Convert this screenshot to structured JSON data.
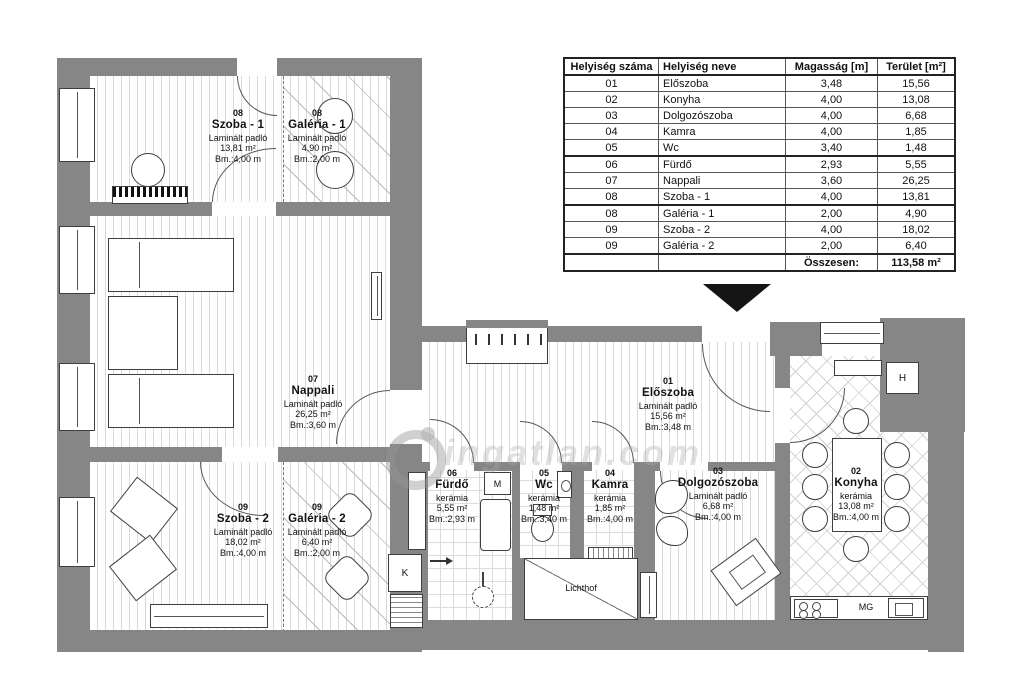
{
  "table": {
    "headers": [
      "Helyiség száma",
      "Helyiség neve",
      "Magasság [m]",
      "Terület [m²]"
    ],
    "rows": [
      [
        "01",
        "Előszoba",
        "3,48",
        "15,56"
      ],
      [
        "02",
        "Konyha",
        "4,00",
        "13,08"
      ],
      [
        "03",
        "Dolgozószoba",
        "4,00",
        "6,68"
      ],
      [
        "04",
        "Kamra",
        "4,00",
        "1,85"
      ],
      [
        "05",
        "Wc",
        "3,40",
        "1,48"
      ],
      [
        "06",
        "Fürdő",
        "2,93",
        "5,55"
      ],
      [
        "07",
        "Nappali",
        "3,60",
        "26,25"
      ],
      [
        "08",
        "Szoba - 1",
        "4,00",
        "13,81"
      ],
      [
        "08",
        "Galéria - 1",
        "2,00",
        "4,90"
      ],
      [
        "09",
        "Szoba - 2",
        "4,00",
        "18,02"
      ],
      [
        "09",
        "Galéria - 2",
        "2,00",
        "6,40"
      ]
    ],
    "total_label": "Összesen:",
    "total_value": "113,58 m²"
  },
  "plan": {
    "rooms": [
      {
        "number": "08",
        "name": "Szoba - 1",
        "floor": "Laminált padló",
        "area": "13,81 m²",
        "height": "Bm.:4,00 m"
      },
      {
        "number": "08",
        "name": "Galéria - 1",
        "floor": "Laminált padló",
        "area": "4,90 m²",
        "height": "Bm.:2,00 m"
      },
      {
        "number": "07",
        "name": "Nappali",
        "floor": "Laminált padló",
        "area": "26,25 m²",
        "height": "Bm.:3,60 m"
      },
      {
        "number": "09",
        "name": "Szoba - 2",
        "floor": "Laminált padló",
        "area": "18,02 m²",
        "height": "Bm.:4,00 m"
      },
      {
        "number": "09",
        "name": "Galéria - 2",
        "floor": "Laminált padló",
        "area": "6,40 m²",
        "height": "Bm.:2,00 m"
      },
      {
        "number": "06",
        "name": "Fürdő",
        "floor": "kerámia",
        "area": "5,55 m²",
        "height": "Bm.:2,93 m"
      },
      {
        "number": "05",
        "name": "Wc",
        "floor": "kerámia",
        "area": "1,48 m²",
        "height": "Bm.:3,40 m"
      },
      {
        "number": "04",
        "name": "Kamra",
        "floor": "kerámia",
        "area": "1,85 m²",
        "height": "Bm.:4,00 m"
      },
      {
        "number": "03",
        "name": "Dolgozószoba",
        "floor": "Laminált padló",
        "area": "6,68 m²",
        "height": "Bm.:4,00 m"
      },
      {
        "number": "01",
        "name": "Előszoba",
        "floor": "Laminált padló",
        "area": "15,56 m²",
        "height": "Bm.:3,48 m"
      },
      {
        "number": "02",
        "name": "Konyha",
        "floor": "kerámia",
        "area": "13,08 m²",
        "height": "Bm.:4,00 m"
      }
    ],
    "annotations": {
      "lichthof": "Lichthof",
      "shaft": "K",
      "washer": "M",
      "fridge": "H",
      "dishwasher": "MG"
    },
    "watermark": "ingatlan.com"
  },
  "colors": {
    "wall": "#868686",
    "line": "#3f3f3f"
  }
}
